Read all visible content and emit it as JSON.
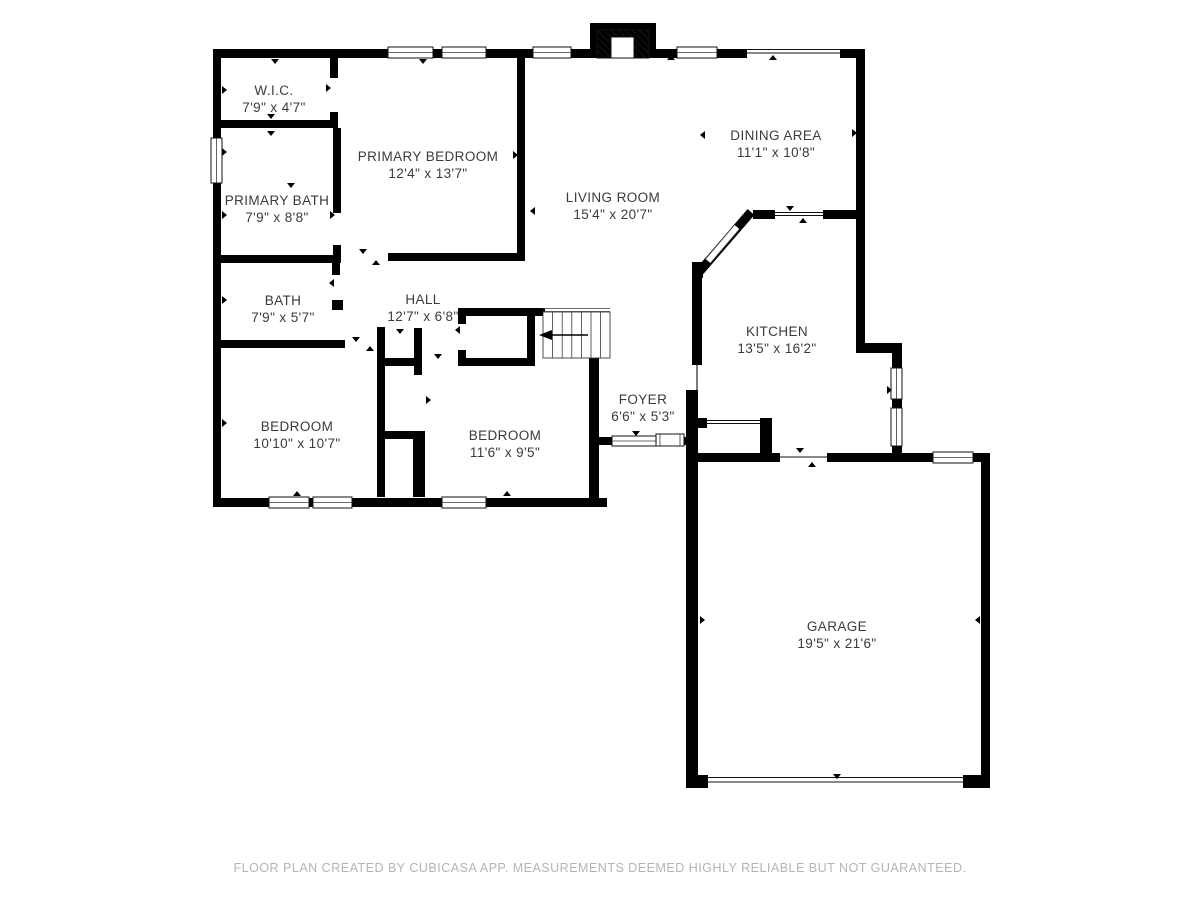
{
  "rooms": [
    {
      "name": "W.I.C.",
      "dims": "7'9\" x 4'7\""
    },
    {
      "name": "PRIMARY BEDROOM",
      "dims": "12'4\" x 13'7\""
    },
    {
      "name": "PRIMARY BATH",
      "dims": "7'9\" x 8'8\""
    },
    {
      "name": "BATH",
      "dims": "7'9\" x 5'7\""
    },
    {
      "name": "HALL",
      "dims": "12'7\" x 6'8\""
    },
    {
      "name": "LIVING ROOM",
      "dims": "15'4\" x 20'7\""
    },
    {
      "name": "DINING AREA",
      "dims": "11'1\" x 10'8\""
    },
    {
      "name": "KITCHEN",
      "dims": "13'5\" x 16'2\""
    },
    {
      "name": "FOYER",
      "dims": "6'6\" x 5'3\""
    },
    {
      "name": "BEDROOM",
      "dims": "10'10\" x 10'7\""
    },
    {
      "name": "BEDROOM",
      "dims": "11'6\" x 9'5\""
    },
    {
      "name": "GARAGE",
      "dims": "19'5\" x 21'6\""
    }
  ],
  "footer": {
    "text": "FLOOR PLAN CREATED BY CUBICASA APP. MEASUREMENTS DEEMED HIGHLY RELIABLE BUT NOT GUARANTEED."
  },
  "colors": {
    "background": "#ffffff",
    "wall": "#000000",
    "room_text": "#3b3b3b",
    "footer_text": "#b4b4b4"
  },
  "icons": {
    "fireplace": "fireplace-icon",
    "stairs": "stairs-icon",
    "entry_door": "entry-door-icon"
  }
}
